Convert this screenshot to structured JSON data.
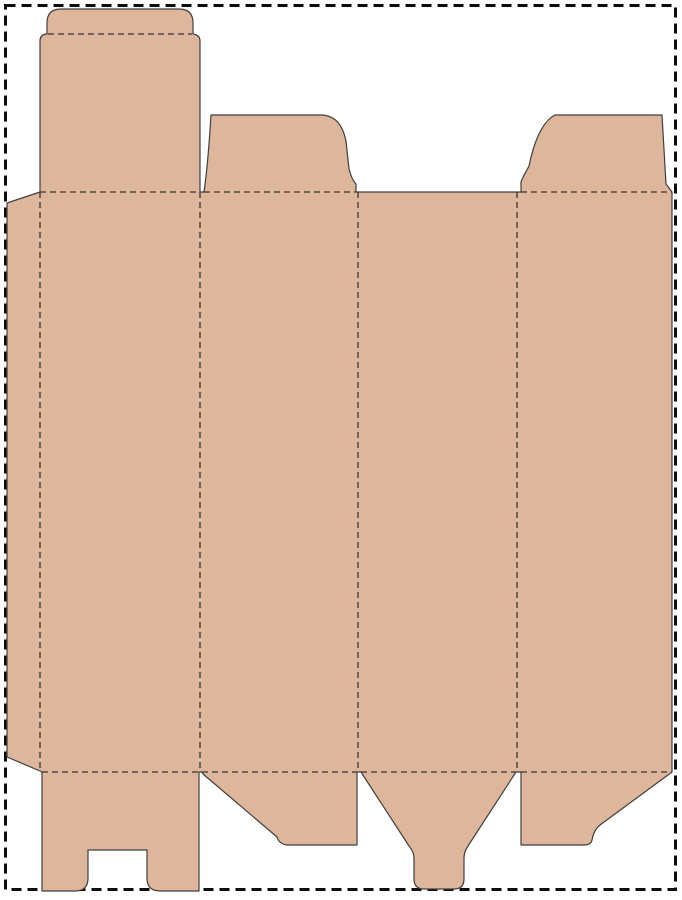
{
  "document": {
    "kind": "packaging-dieline-template",
    "description": "Flat die-cut template (dieline) of a tuck-end folding carton box on a white sheet with a dashed trim border. No visible text."
  },
  "canvas": {
    "width": 682,
    "height": 900,
    "background_color": "#ffffff"
  },
  "palette": {
    "board_fill": "#DDB69C",
    "cut_line": "#3F3F3F",
    "fold_line": "#3A342E",
    "page_border": "#0D0D0D"
  },
  "page_border": {
    "x": 5.5,
    "y": 5.5,
    "width": 670,
    "height": 884,
    "stroke_width": 3,
    "dash_pattern": "10 6"
  },
  "dieline": {
    "outline_stroke_width": 1.2,
    "fold_stroke_width": 1.3,
    "fold_dash_pattern": "6 4",
    "outline_path": "M 7 203 L 40 192 L 40 41 Q 40 35 46 34 L 47 34 L 47 23 Q 47 9 61 9 L 179 9 Q 193 9 193 23 L 193 34 Q 200 35 200 41 L 200 192 L 204 192 C 206 178 209 148 211 115 L 322 115 C 337 116 343 127 346 141 L 349 169 C 351 177 353 181 356 184 L 356 192 L 521 192 L 521 182 C 523 176 526 172 529 166 C 533 146 541 122 555 115 L 662 115 L 666 184 L 672 192 L 672 772 L 600 825 C 595 829 593 834 592 840 Q 591 845 584 845 L 521 845 L 521 772 L 516 772 L 468 846 Q 464 852 464 858 L 464 879 Q 464 889 454 889 L 424 889 Q 414 889 414 879 L 414 858 Q 414 852 409 846 L 361 772 L 357 772 L 357 845 L 287 845 Q 279 844 277 837 L 203 774 L 202 772 L 199 772 L 199 891 L 160 891 Q 147 891 147 878 L 147 850 L 88 850 L 88 878 Q 88 891 75 891 L 42 891 L 42 772 L 40 771 L 7 757 Z",
    "fold_lines": [
      {
        "name": "tuck-flap-fold",
        "path": "M 48 34 L 192 34"
      },
      {
        "name": "top-fold-panel-1",
        "path": "M 40 192 L 200 192"
      },
      {
        "name": "top-fold-panel-2",
        "path": "M 204 192 L 356 192"
      },
      {
        "name": "top-fold-panel-4",
        "path": "M 521 192 L 672 192"
      },
      {
        "name": "bottom-fold-panel-1",
        "path": "M 42 772 L 199 772"
      },
      {
        "name": "bottom-fold-panel-2",
        "path": "M 202 772 L 357 772"
      },
      {
        "name": "bottom-fold-panel-3",
        "path": "M 361 772 L 516 772"
      },
      {
        "name": "bottom-fold-panel-4",
        "path": "M 521 772 L 672 772"
      },
      {
        "name": "glue-flap-fold",
        "path": "M 40 192 L 40 772"
      },
      {
        "name": "fold-panel-1-2",
        "path": "M 200 192 L 200 772"
      },
      {
        "name": "fold-panel-2-3",
        "path": "M 358 192 L 358 772"
      },
      {
        "name": "fold-panel-3-4",
        "path": "M 517 192 L 517 772"
      }
    ],
    "parts": [
      {
        "name": "glue-flap",
        "x": 7,
        "y": 192,
        "w": 33,
        "h": 580
      },
      {
        "name": "top-lid-tuck-flap",
        "x": 40,
        "y": 9,
        "w": 160,
        "h": 183
      },
      {
        "name": "side-panel-1",
        "x": 40,
        "y": 192,
        "w": 160,
        "h": 580
      },
      {
        "name": "top-dust-flap-left",
        "x": 204,
        "y": 115,
        "w": 152,
        "h": 77
      },
      {
        "name": "side-panel-2",
        "x": 200,
        "y": 192,
        "w": 158,
        "h": 580
      },
      {
        "name": "side-panel-3",
        "x": 358,
        "y": 192,
        "w": 159,
        "h": 580
      },
      {
        "name": "top-dust-flap-right",
        "x": 521,
        "y": 115,
        "w": 151,
        "h": 77
      },
      {
        "name": "side-panel-4",
        "x": 517,
        "y": 192,
        "w": 155,
        "h": 580
      },
      {
        "name": "bottom-slotted-flap",
        "x": 42,
        "y": 772,
        "w": 157,
        "h": 119
      },
      {
        "name": "bottom-dust-flap-left",
        "x": 202,
        "y": 772,
        "w": 155,
        "h": 73
      },
      {
        "name": "bottom-tuck-tongue",
        "x": 361,
        "y": 772,
        "w": 155,
        "h": 117
      },
      {
        "name": "bottom-dust-flap-right",
        "x": 521,
        "y": 772,
        "w": 151,
        "h": 73
      }
    ]
  }
}
